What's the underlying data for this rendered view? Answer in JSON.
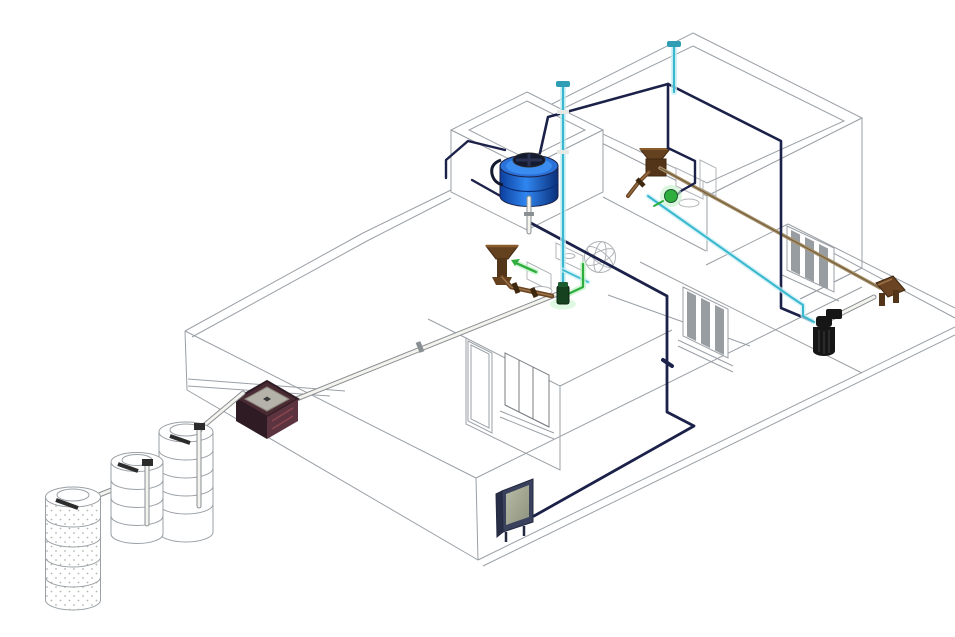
{
  "scene": {
    "label": "Isometric 3D plumbing and drainage diagram of a single-story house",
    "type": "isometric-mep-drawing",
    "background": "#ffffff",
    "visible_text": []
  },
  "canvas": {
    "width": 955,
    "height": 637
  },
  "colors": {
    "line": "#9aa0a6",
    "line-dark": "#787d82",
    "ink": "#2c2c2c",
    "navy": "#1b2149",
    "cyan-core": "#39b7ce",
    "cyan-glow": "#c4eef4",
    "cyan-cap": "#2f9db4",
    "green-core": "#2fae3e",
    "green-glow": "#c2f2c8",
    "green-dark": "#16421f",
    "green-mid": "#1d5c30",
    "tan": "#a8916a",
    "tan-core": "#6e5a3a",
    "brown": "#6b4423",
    "brown-hi": "#9a7348",
    "brown-dark": "#3f2810",
    "funnel": "#64411f",
    "funnel-stem": "#53351a",
    "funnel-rim": "#8a5c2c",
    "box-rim": "#4a2a33",
    "box-plate": "#b5b2a9",
    "box-plate-edge": "#8a857c",
    "box-left": "#2e1b24",
    "box-right": "#5c3440",
    "box-streak": "#8a4550",
    "tank-top": "#2a72d8",
    "tank-ring": "#3b8cf0",
    "tank-lid": "#141a30",
    "tank-lid-hi": "#2a3352",
    "tank-grad-a": "#0c3f9e",
    "tank-grad-b": "#2f86f0",
    "tank-grad-c": "#0a2f7a",
    "pipe-white": "#f4f3ee",
    "pipe-edge": "#8a8f93",
    "panel-body": "#39415c",
    "panel-side": "#272e46",
    "panel-edge": "#232a40",
    "screen-a": "#b9bca6",
    "screen-b": "#8d927e",
    "filter-black": "#161616",
    "filter-ridge": "#3a3a3a",
    "fixture-line": "#b0b4b8",
    "glass": "#989da2",
    "dots": "#b5b5b0",
    "white": "#fdfdfc"
  },
  "components": [
    {
      "name": "rooftop-water-tank",
      "kind": "storage-tank",
      "color_ref": "tank-grad-b"
    },
    {
      "name": "vent-riser-1",
      "kind": "cold-water-vent-riser",
      "color_ref": "cyan-core"
    },
    {
      "name": "vent-riser-2",
      "kind": "cold-water-vent-riser",
      "color_ref": "cyan-core"
    },
    {
      "name": "roof-cold-water-line",
      "kind": "supply-pipe",
      "color_ref": "cyan-core"
    },
    {
      "name": "drain-pipe-network",
      "kind": "drainage-pipe",
      "color_ref": "navy"
    },
    {
      "name": "fixture-supply-loop",
      "kind": "supply-pipe",
      "color_ref": "green-core"
    },
    {
      "name": "roof-sewer-line",
      "kind": "sloped-sewer-pipe",
      "color_ref": "tan"
    },
    {
      "name": "main-sewer-line",
      "kind": "buried-sewer-pipe",
      "color_ref": "pipe-white"
    },
    {
      "name": "roof-drain-funnel-1",
      "kind": "roof-drain",
      "color_ref": "funnel"
    },
    {
      "name": "roof-drain-funnel-2",
      "kind": "roof-drain",
      "color_ref": "funnel"
    },
    {
      "name": "inspection-box",
      "kind": "sanitary-registry-box",
      "color_ref": "box-right"
    },
    {
      "name": "septic-tank-1",
      "kind": "biodigester-tank",
      "color_ref": "white"
    },
    {
      "name": "septic-tank-2",
      "kind": "biodigester-tank",
      "color_ref": "white"
    },
    {
      "name": "leach-cylinder",
      "kind": "perforated-infiltration-tank",
      "color_ref": "white"
    },
    {
      "name": "wall-heater-panel",
      "kind": "tankless-heater",
      "color_ref": "panel-body"
    },
    {
      "name": "water-filter",
      "kind": "inline-filter",
      "color_ref": "filter-black"
    },
    {
      "name": "service-valve-assembly",
      "kind": "hose-bib-valves",
      "color_ref": "brown"
    },
    {
      "name": "bathroom-1-fixtures",
      "kind": "toilet-and-sink",
      "color_ref": "white"
    },
    {
      "name": "bathroom-2-fixtures",
      "kind": "toilet-and-sink",
      "color_ref": "white"
    },
    {
      "name": "shower-sphere-symbol",
      "kind": "wireframe-symbol",
      "color_ref": "line"
    },
    {
      "name": "circulation-pump",
      "kind": "pump-valve",
      "color_ref": "green-dark"
    }
  ]
}
